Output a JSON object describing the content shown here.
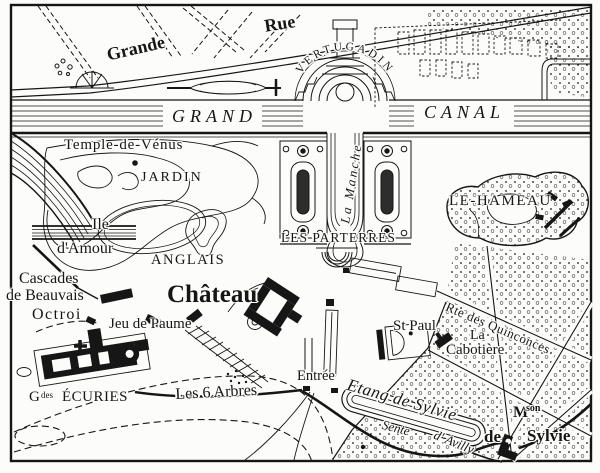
{
  "colors": {
    "paper": "#fcfcfa",
    "ink": "#161616"
  },
  "svg_labels": {
    "vertugadin": "VERTUGADIN",
    "la_manche": "La Manche"
  },
  "labels": [
    {
      "id": "grande",
      "text": "Grande",
      "x": 105,
      "y": 46,
      "fs": 18,
      "rot": -13,
      "b": true
    },
    {
      "id": "rue",
      "text": "Rue",
      "x": 263,
      "y": 17,
      "fs": 18,
      "rot": -9,
      "b": true
    },
    {
      "id": "grand",
      "text": "GRAND",
      "x": 172,
      "y": 107,
      "fs": 18,
      "it": true,
      "ls": 5
    },
    {
      "id": "canal",
      "text": "CANAL",
      "x": 424,
      "y": 103,
      "fs": 18,
      "it": true,
      "ls": 5
    },
    {
      "id": "temple-de-venus",
      "text": "Temple-de-Vénus",
      "x": 64,
      "y": 138,
      "fs": 15,
      "ls": 0.8
    },
    {
      "id": "jardin",
      "text": "JARDIN",
      "x": 141,
      "y": 171,
      "fs": 14,
      "ls": 2
    },
    {
      "id": "ile",
      "text": "Ile",
      "x": 92,
      "y": 217,
      "fs": 16
    },
    {
      "id": "d-amour",
      "text": "d'Amour",
      "x": 57,
      "y": 241,
      "fs": 16
    },
    {
      "id": "anglais",
      "text": "ANGLAIS",
      "x": 151,
      "y": 253,
      "fs": 14.5,
      "ls": 1.5
    },
    {
      "id": "les-parterres",
      "text": "LES PARTERRES",
      "x": 281,
      "y": 231,
      "fs": 13.5,
      "ls": 1
    },
    {
      "id": "le-hameau",
      "text": "LE-HAMEAU",
      "x": 449,
      "y": 194,
      "fs": 15,
      "ls": 1.5
    },
    {
      "id": "cascades",
      "text": "Cascades",
      "x": 19,
      "y": 271,
      "fs": 16
    },
    {
      "id": "de-beauvais",
      "text": "de Beauvais",
      "x": 6,
      "y": 288,
      "fs": 16
    },
    {
      "id": "octroi",
      "text": "Octroi",
      "x": 32,
      "y": 307,
      "fs": 16,
      "ls": 1.5
    },
    {
      "id": "chateau",
      "text": "Château",
      "x": 167,
      "y": 282,
      "fs": 25,
      "b": true
    },
    {
      "id": "jeu-de-paume",
      "text": "Jeu de Paume",
      "x": 109,
      "y": 317,
      "fs": 15
    },
    {
      "id": "ecuries-g",
      "text": "G",
      "x": 29,
      "y": 390,
      "fs": 15
    },
    {
      "id": "ecuries-sup",
      "text": "des",
      "x": 41,
      "y": 391,
      "fs": 9
    },
    {
      "id": "ecuries",
      "text": "ÉCURIES",
      "x": 62,
      "y": 390,
      "fs": 15,
      "ls": 0.5
    },
    {
      "id": "les-6-arbres",
      "text": "Les 6 Arbres",
      "x": 175,
      "y": 387,
      "fs": 16,
      "rot": -3
    },
    {
      "id": "entree",
      "text": "Entrée",
      "x": 297,
      "y": 369,
      "fs": 14.5
    },
    {
      "id": "st-paul",
      "text": "St Paul",
      "x": 393,
      "y": 319,
      "fs": 15
    },
    {
      "id": "rte-des-quinconces",
      "text": "Rte des Quinconces",
      "x": 449,
      "y": 300,
      "fs": 13,
      "rot": 23,
      "ls": 0.5
    },
    {
      "id": "la",
      "text": "La",
      "x": 470,
      "y": 329,
      "fs": 14
    },
    {
      "id": "cabotiere",
      "text": "Cabotière",
      "x": 446,
      "y": 343,
      "fs": 15
    },
    {
      "id": "etang-de-sylvie",
      "text": "Etang de Sylvie",
      "x": 350,
      "y": 376,
      "fs": 17,
      "it": true,
      "rot": 16,
      "ls": 0.5
    },
    {
      "id": "sente",
      "text": "Sente",
      "x": 384,
      "y": 418,
      "fs": 13,
      "it": true,
      "rot": 14
    },
    {
      "id": "d-avilly",
      "text": "d' Avilly",
      "x": 437,
      "y": 428,
      "fs": 13,
      "it": true,
      "rot": 22
    },
    {
      "id": "mson-m",
      "text": "M",
      "x": 513,
      "y": 405,
      "fs": 16,
      "b": true
    },
    {
      "id": "mson-sup",
      "text": "son",
      "x": 526,
      "y": 404,
      "fs": 10,
      "b": true
    },
    {
      "id": "sylvie-de",
      "text": "de",
      "x": 484,
      "y": 428,
      "fs": 17,
      "b": true
    },
    {
      "id": "sylvie",
      "text": "Sylvie",
      "x": 527,
      "y": 427,
      "fs": 17,
      "b": true
    }
  ]
}
